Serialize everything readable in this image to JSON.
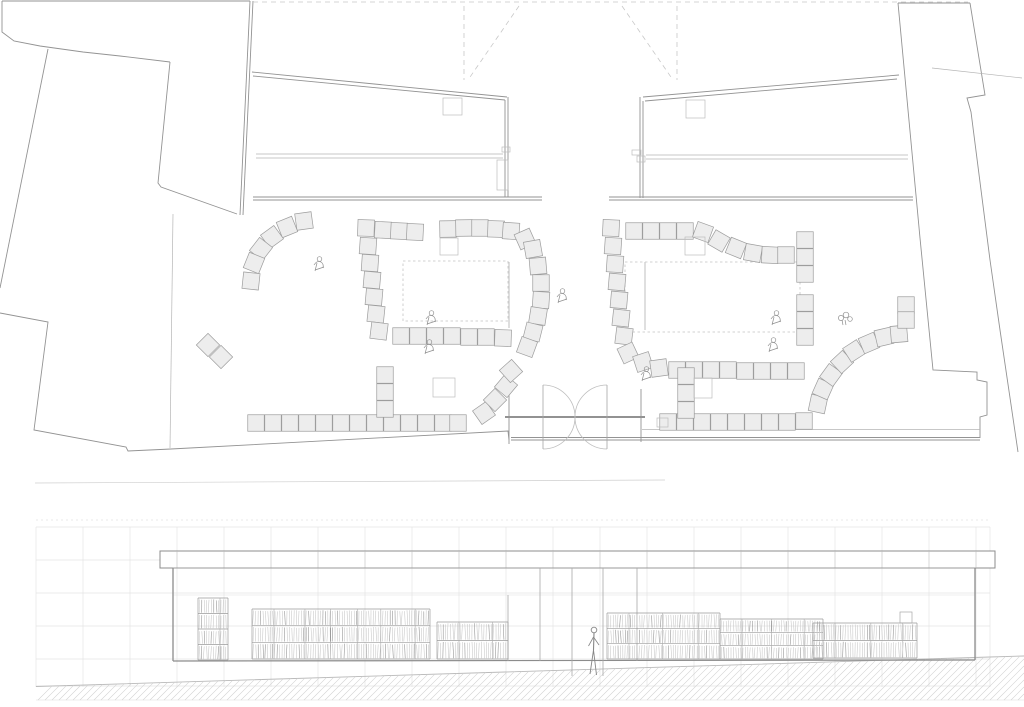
{
  "palette": {
    "wall": "#939393",
    "thin": "#b5b5b5",
    "faint": "#cfcfcf",
    "dark": "#6f6f6f",
    "dash": "#c8c8c8",
    "square_fill": "#ededed",
    "square_stroke": "#9d9d9d",
    "box_stroke": "#bdbdbd",
    "grid": "#e4e4e4",
    "hatch": "#d2d2d2",
    "sketch": "#c6c6c6",
    "sketch_dark": "#8e8e8e",
    "figure": "#8f8f8f"
  },
  "plan": {
    "square_size": 16.5,
    "walls": [
      {
        "p": [
          [
            2,
            1
          ],
          [
            250,
            1
          ]
        ]
      },
      {
        "p": [
          [
            2,
            1
          ],
          [
            2,
            32
          ],
          [
            14,
            41
          ],
          [
            40,
            46
          ],
          [
            83,
            52
          ],
          [
            120,
            56
          ],
          [
            170,
            62
          ]
        ]
      },
      {
        "p": [
          [
            170,
            62
          ],
          [
            158,
            183
          ],
          [
            161,
            187
          ],
          [
            237,
            214
          ]
        ]
      },
      {
        "p": [
          [
            250,
            1
          ],
          [
            240,
            215
          ]
        ]
      },
      {
        "p": [
          [
            253,
            1
          ],
          [
            243,
            215
          ]
        ]
      },
      {
        "p": [
          [
            48,
            49
          ],
          [
            0,
            288
          ]
        ]
      },
      {
        "p": [
          [
            0,
            313
          ],
          [
            48,
            322
          ],
          [
            34,
            430
          ],
          [
            126,
            447
          ],
          [
            128,
            451
          ],
          [
            171,
            449
          ]
        ]
      },
      {
        "p": [
          [
            173,
            214
          ],
          [
            170,
            448
          ]
        ],
        "t": "thin"
      },
      {
        "p": [
          [
            252,
            72
          ],
          [
            507,
            97
          ]
        ]
      },
      {
        "p": [
          [
            253,
            76
          ],
          [
            505,
            100
          ]
        ]
      },
      {
        "p": [
          [
            505,
            100
          ],
          [
            505,
            197
          ]
        ]
      },
      {
        "p": [
          [
            508,
            97
          ],
          [
            508,
            197
          ]
        ]
      },
      {
        "p": [
          [
            253,
            197
          ],
          [
            542,
            197
          ]
        ]
      },
      {
        "p": [
          [
            253,
            200
          ],
          [
            542,
            200
          ]
        ]
      },
      {
        "p": [
          [
            256,
            154
          ],
          [
            503,
            154
          ]
        ],
        "t": "thin"
      },
      {
        "p": [
          [
            256,
            158
          ],
          [
            503,
            158
          ]
        ],
        "t": "thin"
      },
      {
        "p": [
          [
            643,
            97
          ],
          [
            899,
            75
          ]
        ]
      },
      {
        "p": [
          [
            645,
            101
          ],
          [
            897,
            79
          ]
        ]
      },
      {
        "p": [
          [
            640,
            97
          ],
          [
            640,
            198
          ]
        ]
      },
      {
        "p": [
          [
            643,
            101
          ],
          [
            643,
            198
          ]
        ]
      },
      {
        "p": [
          [
            609,
            197
          ],
          [
            913,
            197
          ]
        ]
      },
      {
        "p": [
          [
            609,
            200
          ],
          [
            913,
            200
          ]
        ]
      },
      {
        "p": [
          [
            646,
            155
          ],
          [
            908,
            155
          ]
        ],
        "t": "thin"
      },
      {
        "p": [
          [
            646,
            159
          ],
          [
            908,
            159
          ]
        ],
        "t": "thin"
      },
      {
        "p": [
          [
            898,
            3
          ],
          [
            920,
            238
          ],
          [
            933,
            370
          ],
          [
            977,
            372
          ],
          [
            977,
            380
          ],
          [
            987,
            382
          ],
          [
            987,
            415
          ],
          [
            980,
            417
          ],
          [
            980,
            438
          ]
        ]
      },
      {
        "p": [
          [
            898,
            3
          ],
          [
            970,
            3
          ]
        ]
      },
      {
        "p": [
          [
            970,
            3
          ],
          [
            985,
            95
          ],
          [
            967,
            98
          ],
          [
            971,
            112
          ],
          [
            990,
            260
          ],
          [
            1000,
            330
          ],
          [
            1018,
            452
          ]
        ]
      },
      {
        "p": [
          [
            932,
            68
          ],
          [
            1022,
            78
          ]
        ],
        "t": "thin"
      },
      {
        "p": [
          [
            171,
            449
          ],
          [
            508,
            431
          ],
          [
            509,
            440
          ]
        ]
      },
      {
        "p": [
          [
            511,
            437.5
          ],
          [
            980,
            437.5
          ]
        ]
      },
      {
        "p": [
          [
            511,
            440
          ],
          [
            980,
            440
          ]
        ]
      },
      {
        "p": [
          [
            642,
            429.5
          ],
          [
            980,
            429.5
          ]
        ],
        "t": "thin"
      },
      {
        "p": [
          [
            35,
            483
          ],
          [
            665,
            480
          ]
        ],
        "t": "faint"
      },
      {
        "p": [
          [
            505,
            417
          ],
          [
            645,
            417
          ]
        ],
        "t": "dark"
      },
      {
        "p": [
          [
            509,
            385
          ],
          [
            509,
            444
          ]
        ]
      },
      {
        "p": [
          [
            641,
            389
          ],
          [
            641,
            442
          ]
        ]
      }
    ],
    "dashes": [
      [
        [
          253,
          2
        ],
        [
          968,
          2
        ]
      ],
      [
        [
          464,
          6
        ],
        [
          464,
          80
        ]
      ],
      [
        [
          519,
          6
        ],
        [
          468,
          80
        ]
      ],
      [
        [
          677,
          6
        ],
        [
          677,
          80
        ]
      ],
      [
        [
          622,
          6
        ],
        [
          673,
          80
        ]
      ]
    ],
    "dashed_rects": [
      [
        403,
        261,
        105,
        60
      ],
      [
        625,
        262,
        175,
        70
      ]
    ],
    "faint_lines": [
      [
        [
          509,
          262
        ],
        [
          509,
          328
        ]
      ],
      [
        [
          645,
          262
        ],
        [
          645,
          330
        ]
      ]
    ],
    "boxes": [
      [
        443,
        98,
        19,
        17
      ],
      [
        686,
        100,
        19,
        18
      ],
      [
        497,
        160,
        11,
        30
      ],
      [
        502,
        147,
        8,
        5
      ],
      [
        632,
        150,
        9,
        5
      ],
      [
        637,
        156,
        8,
        6
      ],
      [
        440,
        238,
        18,
        17
      ],
      [
        685,
        237,
        20,
        18
      ],
      [
        433,
        378,
        22,
        19
      ],
      [
        694,
        378,
        18,
        20
      ],
      [
        657,
        418,
        11,
        9
      ]
    ],
    "squares": [
      [
        304,
        221,
        -8
      ],
      [
        287,
        227,
        -22
      ],
      [
        272,
        237,
        -36
      ],
      [
        261,
        249,
        -52
      ],
      [
        254,
        263,
        -68
      ],
      [
        251,
        281,
        -84
      ],
      [
        208,
        345,
        45
      ],
      [
        221,
        357,
        45
      ],
      [
        366,
        228,
        2
      ],
      [
        383,
        230,
        3
      ],
      [
        399,
        231,
        3
      ],
      [
        415,
        232,
        3
      ],
      [
        368,
        246,
        4
      ],
      [
        370,
        263,
        4
      ],
      [
        372,
        280,
        5
      ],
      [
        374,
        297,
        5
      ],
      [
        376,
        314,
        6
      ],
      [
        379,
        331,
        7
      ],
      [
        448,
        229,
        -1
      ],
      [
        464,
        228,
        -1
      ],
      [
        480,
        228,
        0
      ],
      [
        496,
        229,
        2
      ],
      [
        511,
        231,
        4
      ],
      [
        525,
        239,
        -24
      ],
      [
        533,
        249,
        -10
      ],
      [
        538,
        266,
        -5
      ],
      [
        541,
        283,
        0
      ],
      [
        541,
        300,
        4
      ],
      [
        538,
        316,
        9
      ],
      [
        533,
        332,
        14
      ],
      [
        527,
        347,
        20
      ],
      [
        401,
        336,
        0
      ],
      [
        418,
        336,
        0
      ],
      [
        435,
        336,
        0
      ],
      [
        452,
        336,
        0
      ],
      [
        469,
        337,
        0
      ],
      [
        486,
        337,
        0
      ],
      [
        503,
        338,
        2
      ],
      [
        611,
        228,
        3
      ],
      [
        613,
        246,
        4
      ],
      [
        615,
        264,
        4
      ],
      [
        617,
        282,
        5
      ],
      [
        619,
        300,
        5
      ],
      [
        621,
        318,
        6
      ],
      [
        624,
        336,
        7
      ],
      [
        634,
        231,
        0
      ],
      [
        651,
        231,
        0
      ],
      [
        668,
        231,
        0
      ],
      [
        685,
        231,
        0
      ],
      [
        703,
        232,
        20
      ],
      [
        719,
        241,
        30
      ],
      [
        736,
        248,
        22
      ],
      [
        753,
        253,
        10
      ],
      [
        770,
        255,
        3
      ],
      [
        786,
        255,
        0
      ],
      [
        805,
        240,
        0
      ],
      [
        805,
        257,
        0
      ],
      [
        805,
        274,
        0
      ],
      [
        805,
        303,
        0
      ],
      [
        805,
        320,
        0
      ],
      [
        805,
        337,
        0
      ],
      [
        628,
        353,
        -25
      ],
      [
        643,
        362,
        -18
      ],
      [
        659,
        368,
        -8
      ],
      [
        677,
        370,
        0
      ],
      [
        694,
        370,
        0
      ],
      [
        711,
        370,
        0
      ],
      [
        728,
        370,
        0
      ],
      [
        745,
        371,
        0
      ],
      [
        762,
        371,
        0
      ],
      [
        779,
        371,
        0
      ],
      [
        796,
        371,
        0
      ],
      [
        256,
        423,
        0
      ],
      [
        273,
        423,
        0
      ],
      [
        290,
        423,
        0
      ],
      [
        307,
        423,
        0
      ],
      [
        324,
        423,
        0
      ],
      [
        341,
        423,
        0
      ],
      [
        358,
        423,
        0
      ],
      [
        375,
        423,
        0
      ],
      [
        392,
        423,
        0
      ],
      [
        409,
        423,
        0
      ],
      [
        426,
        423,
        0
      ],
      [
        443,
        423,
        0
      ],
      [
        458,
        423,
        0
      ],
      [
        385,
        375,
        0
      ],
      [
        385,
        392,
        0
      ],
      [
        385,
        409,
        0
      ],
      [
        484,
        413,
        -35
      ],
      [
        495,
        400,
        -45
      ],
      [
        506,
        386,
        -50
      ],
      [
        511,
        371,
        -42
      ],
      [
        668,
        422,
        0
      ],
      [
        685,
        422,
        0
      ],
      [
        702,
        422,
        0
      ],
      [
        719,
        422,
        0
      ],
      [
        736,
        422,
        0
      ],
      [
        753,
        422,
        0
      ],
      [
        770,
        422,
        0
      ],
      [
        787,
        422,
        0
      ],
      [
        804,
        421,
        0
      ],
      [
        686,
        376,
        0
      ],
      [
        686,
        393,
        0
      ],
      [
        686,
        410,
        0
      ],
      [
        818,
        404,
        -78
      ],
      [
        823,
        389,
        -66
      ],
      [
        831,
        375,
        -54
      ],
      [
        842,
        362,
        -43
      ],
      [
        854,
        351,
        -33
      ],
      [
        869,
        343,
        -23
      ],
      [
        884,
        337,
        -13
      ],
      [
        899,
        334,
        -5
      ],
      [
        906,
        305,
        0
      ],
      [
        906,
        320,
        0
      ]
    ],
    "door": {
      "hinge_left": 543,
      "hinge_right": 607,
      "cy": 417,
      "r": 32,
      "meet_x": 575,
      "tip_top": 385,
      "tip_bot": 449
    },
    "figures": [
      {
        "t": "person",
        "x": 319,
        "y": 264
      },
      {
        "t": "person",
        "x": 431,
        "y": 318
      },
      {
        "t": "person",
        "x": 429,
        "y": 347
      },
      {
        "t": "person",
        "x": 562,
        "y": 296
      },
      {
        "t": "person",
        "x": 776,
        "y": 318
      },
      {
        "t": "person",
        "x": 773,
        "y": 345
      },
      {
        "t": "person",
        "x": 646,
        "y": 374
      },
      {
        "t": "plant",
        "x": 845,
        "y": 318
      }
    ]
  },
  "elevation": {
    "backdrop": {
      "x1": 36,
      "y1": 520,
      "x2": 990,
      "y2": 687,
      "dx": 47,
      "rows": [
        527,
        560,
        593,
        626,
        659,
        686
      ],
      "top_dotted": 520
    },
    "canopy": {
      "x1": 160,
      "x2": 995,
      "y1": 551,
      "y2": 568
    },
    "storefront": {
      "x1": 173,
      "x2": 975,
      "top": 568,
      "floor": 661,
      "shelf_datum": 595
    },
    "mullions": [
      {
        "x": 508,
        "y1": 595,
        "y2": 661
      },
      {
        "x": 540,
        "y1": 568,
        "y2": 661
      },
      {
        "x": 572,
        "y1": 568,
        "y2": 676
      },
      {
        "x": 603,
        "y1": 568,
        "y2": 676
      },
      {
        "x": 637,
        "y1": 568,
        "y2": 661
      }
    ],
    "shelves": [
      {
        "x1": 198,
        "x2": 228,
        "top": 598,
        "bot": 660,
        "rows": 4
      },
      {
        "x1": 252,
        "x2": 430,
        "top": 609,
        "bot": 659,
        "rows": 3
      },
      {
        "x1": 437,
        "x2": 508,
        "top": 622,
        "bot": 659,
        "rows": 2
      },
      {
        "x1": 607,
        "x2": 720,
        "top": 613,
        "bot": 659,
        "rows": 3
      },
      {
        "x1": 720,
        "x2": 823,
        "top": 619,
        "bot": 659,
        "rows": 3
      },
      {
        "x1": 813,
        "x2": 917,
        "top": 623,
        "bot": 658,
        "rows": 2
      }
    ],
    "shelf_box": [
      900,
      612,
      12,
      11
    ],
    "person": {
      "x": 594,
      "y": 630
    },
    "ground": {
      "top_pts": [
        [
          36,
          686.5
        ],
        [
          990,
          657
        ],
        [
          1024,
          656
        ]
      ],
      "bottom": 700,
      "step": 7
    }
  }
}
